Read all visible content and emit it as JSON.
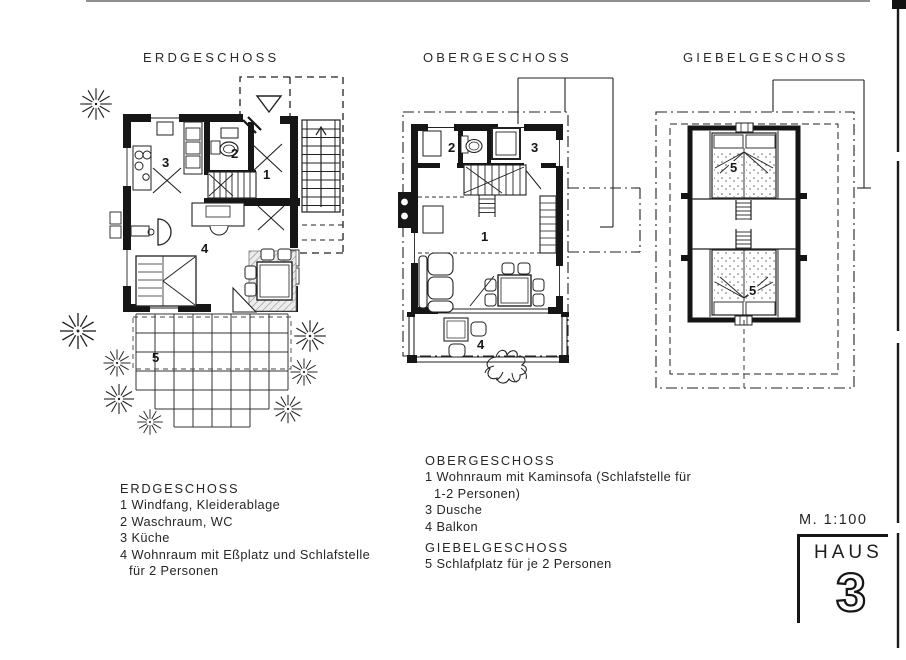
{
  "plans": {
    "erdgeschoss": {
      "title": "ERDGESCHOSS",
      "room_labels": {
        "windfang": "1",
        "waschraum": "2",
        "kueche": "3",
        "wohnraum": "4",
        "terrasse": "5"
      }
    },
    "obergeschoss": {
      "title": "OBERGESCHOSS",
      "room_labels": {
        "wohnraum": "1",
        "waschraum": "2",
        "dusche": "3",
        "balkon": "4"
      }
    },
    "giebelgeschoss": {
      "title": "GIEBELGESCHOSS",
      "room_labels": {
        "schlafplatz_oben": "5",
        "schlafplatz_unten": "5"
      }
    }
  },
  "legends": {
    "erdgeschoss": {
      "title": "ERDGESCHOSS",
      "lines": [
        "1 Windfang, Kleiderablage",
        "2 Waschraum, WC",
        "3 Küche",
        "4 Wohnraum mit Eßplatz und Schlafstelle",
        "für 2 Personen"
      ]
    },
    "obergeschoss": {
      "title": "OBERGESCHOSS",
      "lines": [
        "1 Wohnraum mit Kaminsofa (Schlafstelle für",
        "1-2 Personen)",
        "3 Dusche",
        "4 Balkon"
      ]
    },
    "giebelgeschoss": {
      "title": "GIEBELGESCHOSS",
      "lines": [
        "5 Schlafplatz für je 2 Personen"
      ]
    }
  },
  "titleblock": {
    "scale": "M. 1:100",
    "house_label": "HAUS",
    "house_number": "3"
  },
  "ink_color": "#1f1f1f"
}
